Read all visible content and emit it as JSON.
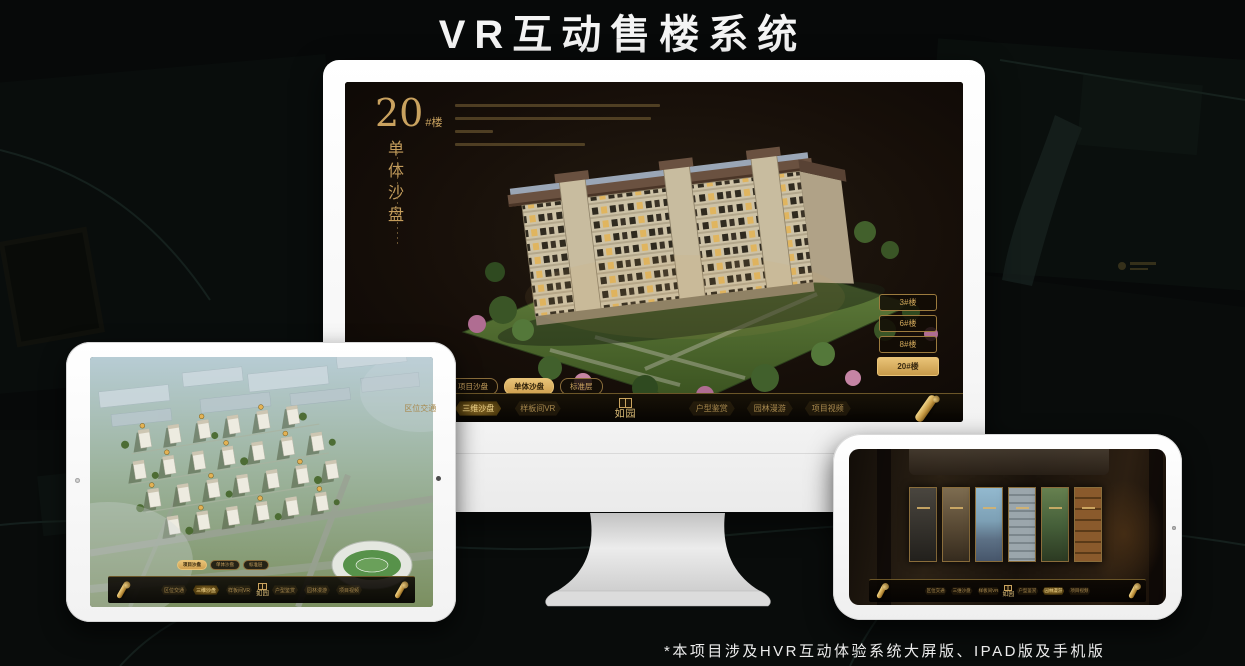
{
  "page": {
    "title": "VR互动售楼系统",
    "footnote": "*本项目涉及HVR互动体验系统大屏版、IPAD版及手机版"
  },
  "colors": {
    "accent_gold": "#c9a25f",
    "accent_gold_bright": "#e8c377",
    "screen_bg": "#14100b",
    "nav_bg": "#0b0804",
    "selected_button_bg": "#d9af62"
  },
  "brand": {
    "logo_text": "如园"
  },
  "nav_items": [
    {
      "label": "区位交通"
    },
    {
      "label": "三维沙盘"
    },
    {
      "label": "样板间VR"
    },
    {
      "label": "户型鉴赏"
    },
    {
      "label": "园林漫游"
    },
    {
      "label": "项目视频"
    }
  ],
  "sub_tabs": [
    {
      "label": "项目沙盘"
    },
    {
      "label": "单体沙盘"
    },
    {
      "label": "标准层"
    }
  ],
  "monitor": {
    "unit_big": "20",
    "unit_small": "#楼",
    "mode_vertical": "单体沙盘",
    "selected_sub_tab": "单体沙盘",
    "selected_nav": "三维沙盘",
    "building_buttons": [
      {
        "label": "3#楼",
        "selected": false
      },
      {
        "label": "6#楼",
        "selected": false
      },
      {
        "label": "8#楼",
        "selected": false
      },
      {
        "label": "20#楼",
        "selected": true
      }
    ]
  },
  "ipad": {
    "selected_sub_tab": "项目沙盘",
    "selected_nav": "三维沙盘"
  },
  "phone": {
    "selected_nav": "园林漫游"
  }
}
